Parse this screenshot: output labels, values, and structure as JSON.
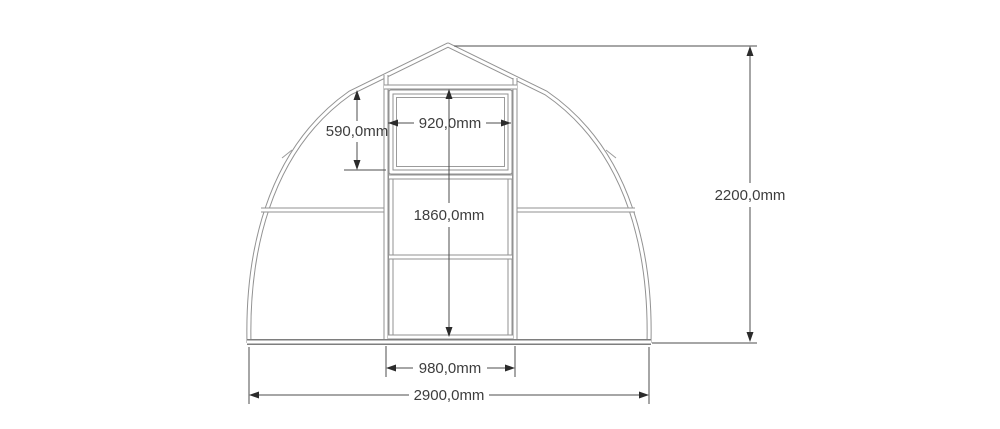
{
  "drawing": {
    "units": "mm",
    "dimensions": {
      "window_height": {
        "label": "590,0mm",
        "value_mm": 590.0
      },
      "window_width": {
        "label": "920,0mm",
        "value_mm": 920.0
      },
      "door_opening_height": {
        "label": "1860,0mm",
        "value_mm": 1860.0
      },
      "overall_height": {
        "label": "2200,0mm",
        "value_mm": 2200.0
      },
      "door_width": {
        "label": "980,0mm",
        "value_mm": 980.0
      },
      "overall_width": {
        "label": "2900,0mm",
        "value_mm": 2900.0
      }
    },
    "colors": {
      "frame_gray": "#929292",
      "base_gray": "#7e7e7e",
      "dimension_line": "#4d4d4d",
      "arrow": "#2b2b2b",
      "label_text": "#3d3d3d",
      "background": "#ffffff"
    }
  }
}
